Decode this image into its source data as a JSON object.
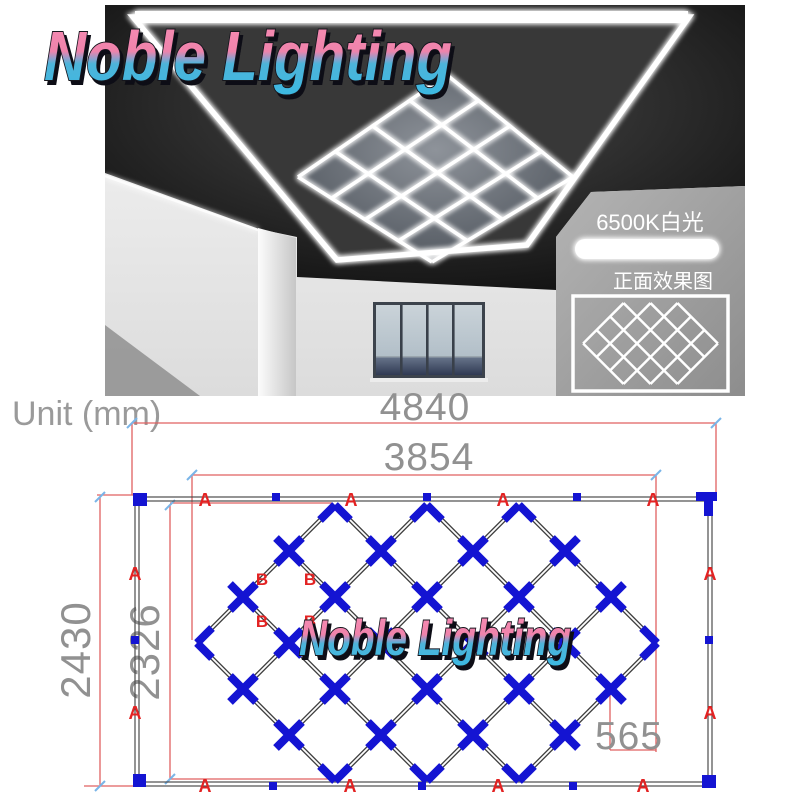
{
  "page": {
    "background": "#ffffff"
  },
  "brand": {
    "logo_text": "Noble Lighting",
    "gradient_top": "#f287ae",
    "gradient_bottom": "#3fb6e0",
    "outline_color": "#14141e"
  },
  "photo": {
    "badges": {
      "color_temp": "6500K白光",
      "front_view_label": "正面效果图"
    }
  },
  "diagram": {
    "unit_label": "Unit (mm)",
    "dims": {
      "outer_width": "4840",
      "inner_width": "3854",
      "outer_height": "2430",
      "inner_height": "2326",
      "diamond_half": "565"
    },
    "part_labels": {
      "a": "A",
      "b": "B"
    },
    "colors": {
      "dim_line": "#e06060",
      "dim_text": "#919191",
      "part_label": "#e32222",
      "connector_blue": "#1414d2",
      "frame_line": "#4c4c4c",
      "tick_cyan": "#7ab5e8"
    }
  }
}
